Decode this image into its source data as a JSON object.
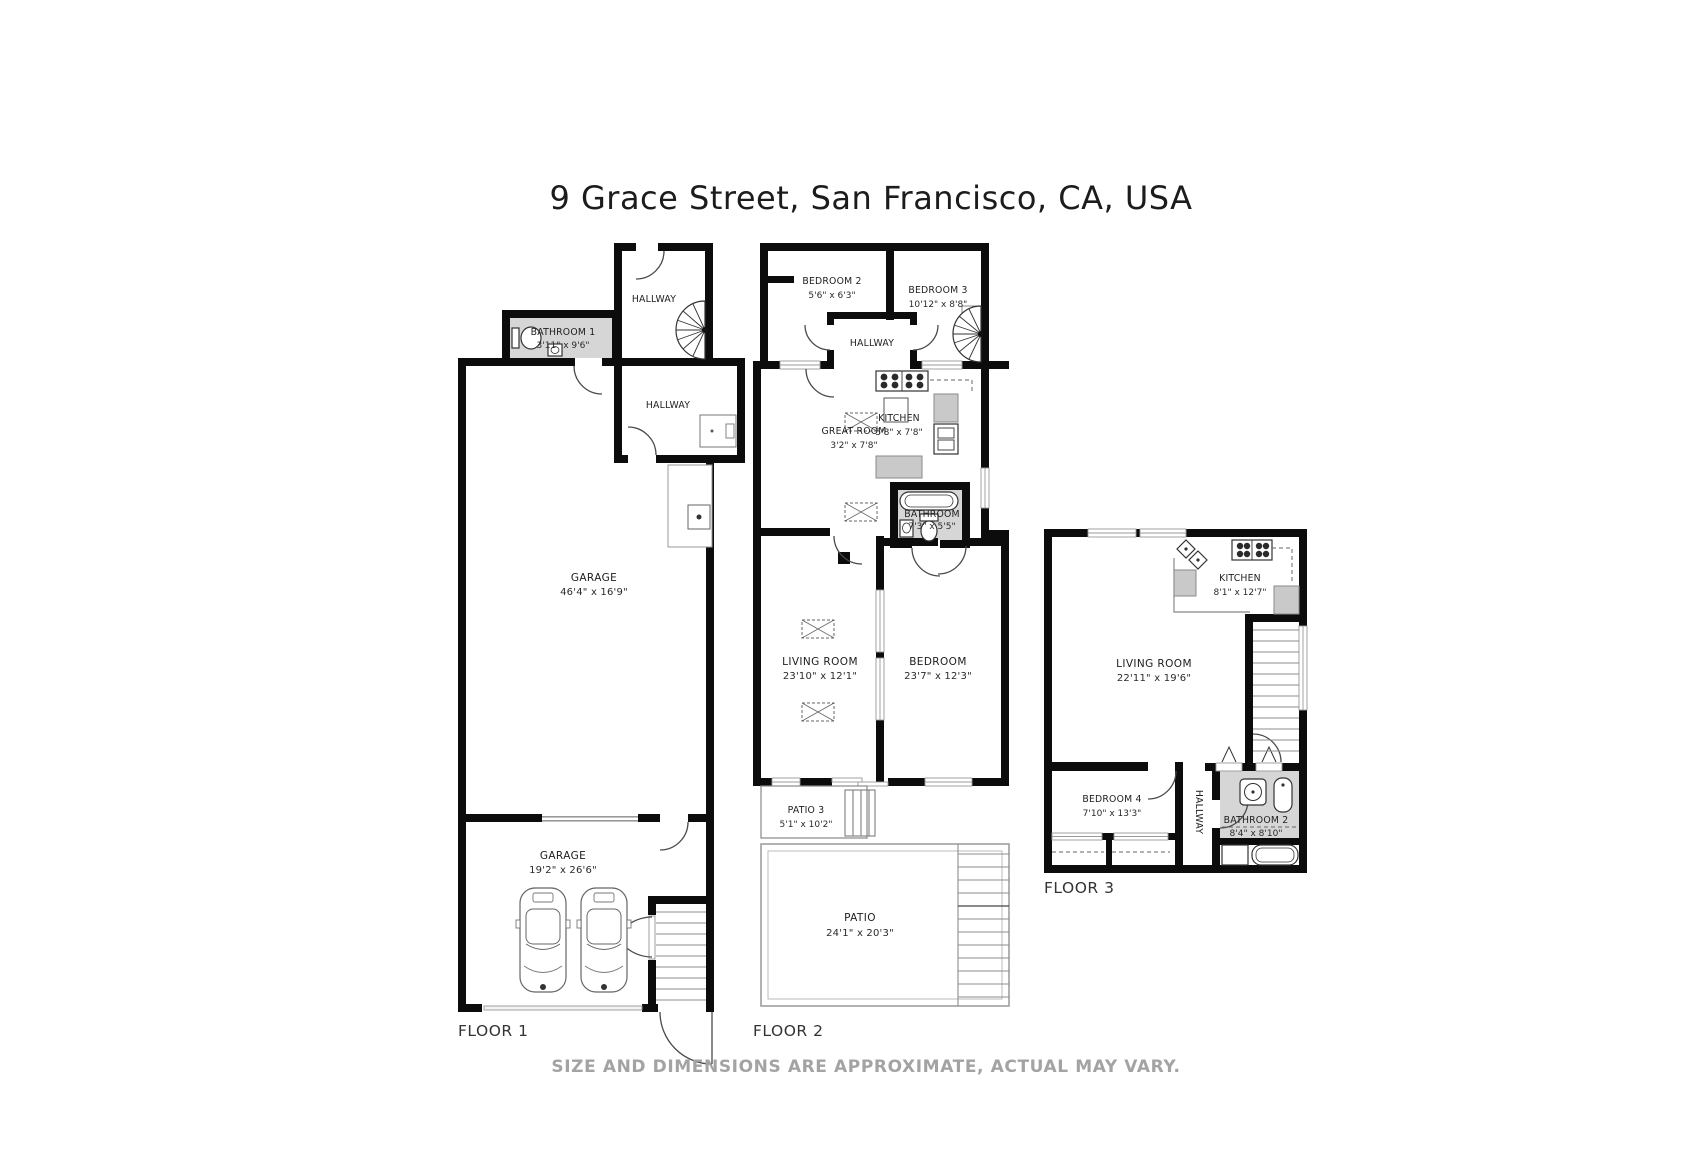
{
  "page": {
    "title": "9 Grace Street, San Francisco, CA, USA",
    "disclaimer": "SIZE AND DIMENSIONS ARE APPROXIMATE, ACTUAL MAY VARY."
  },
  "icons": [
    "spiral-staircase-icon",
    "staircase-icon",
    "car-icon",
    "toilet-icon",
    "sink-icon",
    "bathtub-icon",
    "shower-icon",
    "stove-icon",
    "skylight-icon",
    "door-arc-icon",
    "water-heater-icon",
    "refrigerator-icon"
  ],
  "floor1": {
    "label": "FLOOR 1",
    "rooms": {
      "hallway_upper": {
        "name": "HALLWAY"
      },
      "bathroom1": {
        "name": "BATHROOM 1",
        "dims": "3'11\" x 9'6\""
      },
      "hallway_lower": {
        "name": "HALLWAY"
      },
      "garage_main": {
        "name": "GARAGE",
        "dims": "46'4\" x 16'9\""
      },
      "garage_lower": {
        "name": "GARAGE",
        "dims": "19'2\" x 26'6\""
      }
    }
  },
  "floor2": {
    "label": "FLOOR 2",
    "rooms": {
      "bedroom2": {
        "name": "BEDROOM 2",
        "dims": "5'6\" x 6'3\""
      },
      "bedroom3": {
        "name": "BEDROOM 3",
        "dims": "10'12\" x 8'8\""
      },
      "hallway": {
        "name": "HALLWAY"
      },
      "great_room": {
        "name": "GREAT ROOM",
        "dims": "3'2\" x 7'8\""
      },
      "kitchen": {
        "name": "KITCHEN",
        "dims": "5'8\" x 7'8\""
      },
      "bathroom": {
        "name": "BATHROOM",
        "dims": "7'3\" x 5'5\""
      },
      "living_room": {
        "name": "LIVING ROOM",
        "dims": "23'10\" x 12'1\""
      },
      "bedroom": {
        "name": "BEDROOM",
        "dims": "23'7\" x 12'3\""
      },
      "patio3": {
        "name": "PATIO 3",
        "dims": "5'1\" x 10'2\""
      },
      "patio": {
        "name": "PATIO",
        "dims": "24'1\" x 20'3\""
      }
    }
  },
  "floor3": {
    "label": "FLOOR 3",
    "rooms": {
      "kitchen": {
        "name": "KITCHEN",
        "dims": "8'1\" x 12'7\""
      },
      "living_room": {
        "name": "LIVING ROOM",
        "dims": "22'11\" x 19'6\""
      },
      "bedroom4": {
        "name": "BEDROOM 4",
        "dims": "7'10\" x 13'3\""
      },
      "hallway": {
        "name": "HALLWAY"
      },
      "bathroom2": {
        "name": "BATHROOM 2",
        "dims": "8'4\" x 8'10\""
      }
    }
  }
}
